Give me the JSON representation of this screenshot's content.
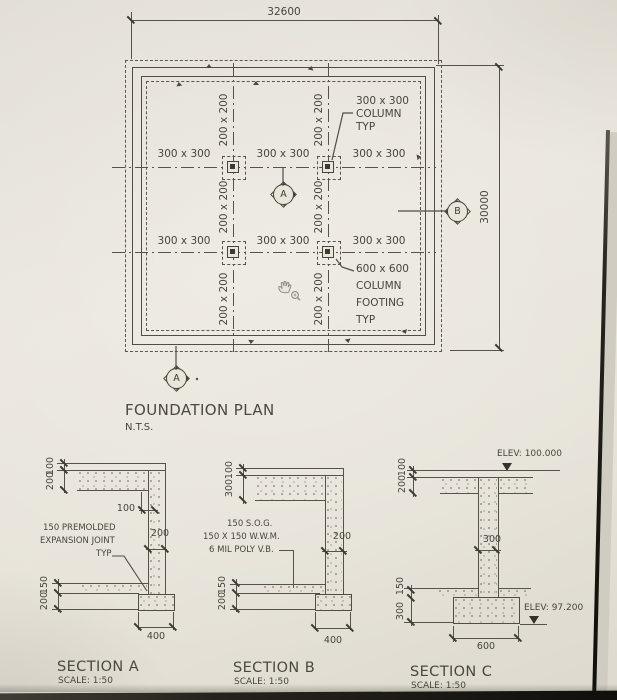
{
  "drawing": {
    "plan": {
      "title": "FOUNDATION PLAN",
      "scale_note": "N.T.S.",
      "dim_width": "32600",
      "dim_height": "30000",
      "column_size_label": "300 x 300",
      "grid_size_label": "200 x 200",
      "column_callout": [
        "300 x 300",
        "COLUMN",
        "TYP"
      ],
      "footing_callout": [
        "600 x 600",
        "COLUMN",
        "FOOTING",
        "TYP"
      ],
      "section_marker_a": "A",
      "section_marker_b": "B"
    },
    "section_a": {
      "title": "SECTION A",
      "scale": "SCALE: 1:50",
      "dim_top_1": "100",
      "dim_top_2": "200",
      "dim_step": "100",
      "dim_wall": "200",
      "dim_bot_1": "150",
      "dim_bot_2": "200",
      "dim_footing": "400",
      "note": [
        "150 PREMOLDED",
        "EXPANSION JOINT",
        "TYP"
      ]
    },
    "section_b": {
      "title": "SECTION B",
      "scale": "SCALE: 1:50",
      "dim_top_1": "100",
      "dim_top_2": "300",
      "dim_wall": "200",
      "dim_bot_1": "150",
      "dim_bot_2": "200",
      "dim_footing": "400",
      "note": [
        "150 S.O.G.",
        "150 X 150 W.W.M.",
        "6 MIL POLY V.B."
      ]
    },
    "section_c": {
      "title": "SECTION C",
      "scale": "SCALE: 1:50",
      "dim_top_1": "100",
      "dim_top_2": "200",
      "dim_wall": "300",
      "dim_bot_1": "150",
      "dim_bot_2": "300",
      "dim_footing": "600",
      "elev_top": "ELEV: 100.000",
      "elev_bottom": "ELEV: 97.200"
    },
    "icons": {
      "cursor": "hand-zoom-cursor"
    },
    "colors": {
      "paper": "#e8e4da",
      "ink": "#4b493f"
    }
  }
}
